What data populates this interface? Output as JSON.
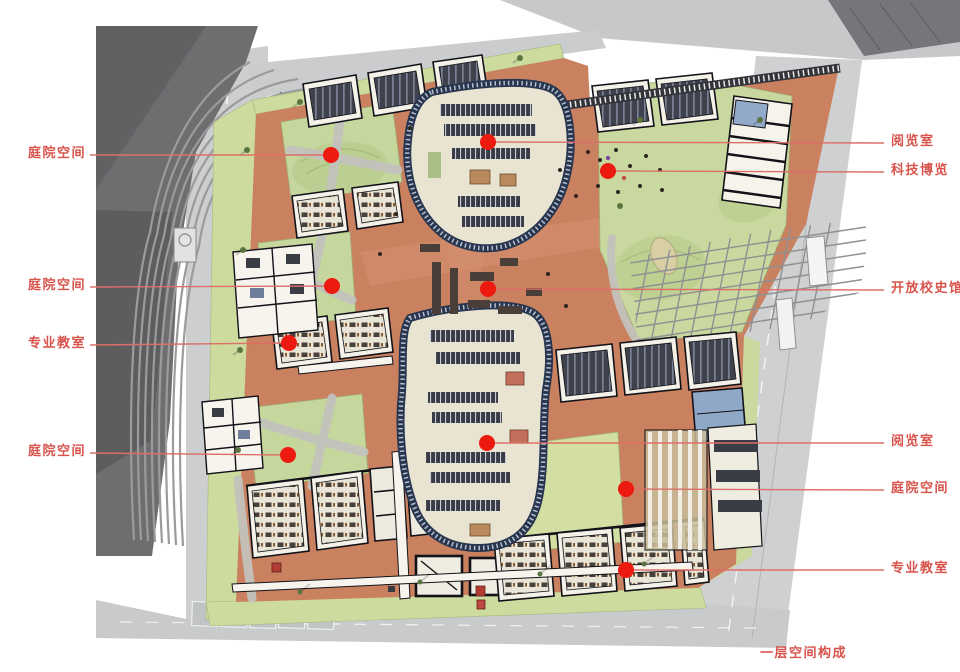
{
  "caption": "一层空间构成",
  "colors": {
    "label_red": "#d8534c",
    "dot_red": "#ed1a10",
    "leader_red": "#dd6f68",
    "plaza_orange": "#ca8160",
    "lawn_green": "#c6d79e",
    "road_gray": "#cbccce",
    "stadium_gray": "#6e6e71",
    "blob_edge_navy": "#2e3c57"
  },
  "annotations": {
    "left": [
      {
        "label": "庭院空间",
        "y": 155,
        "dot": [
          331,
          155
        ]
      },
      {
        "label": "庭院空间",
        "y": 287,
        "dot": [
          332,
          286
        ]
      },
      {
        "label": "专业教室",
        "y": 345,
        "dot": [
          289,
          343
        ]
      },
      {
        "label": "庭院空间",
        "y": 453,
        "dot": [
          288,
          455
        ]
      }
    ],
    "right": [
      {
        "label": "阅览室",
        "y": 143,
        "dot": [
          488,
          142
        ]
      },
      {
        "label": "科技博览",
        "y": 172,
        "dot": [
          608,
          171
        ]
      },
      {
        "label": "开放校史馆",
        "y": 290,
        "dot": [
          488,
          289
        ]
      },
      {
        "label": "阅览室",
        "y": 443,
        "dot": [
          487,
          443
        ]
      },
      {
        "label": "庭院空间",
        "y": 490,
        "dot": [
          626,
          489
        ]
      },
      {
        "label": "专业教室",
        "y": 570,
        "dot": [
          626,
          570
        ]
      }
    ]
  }
}
